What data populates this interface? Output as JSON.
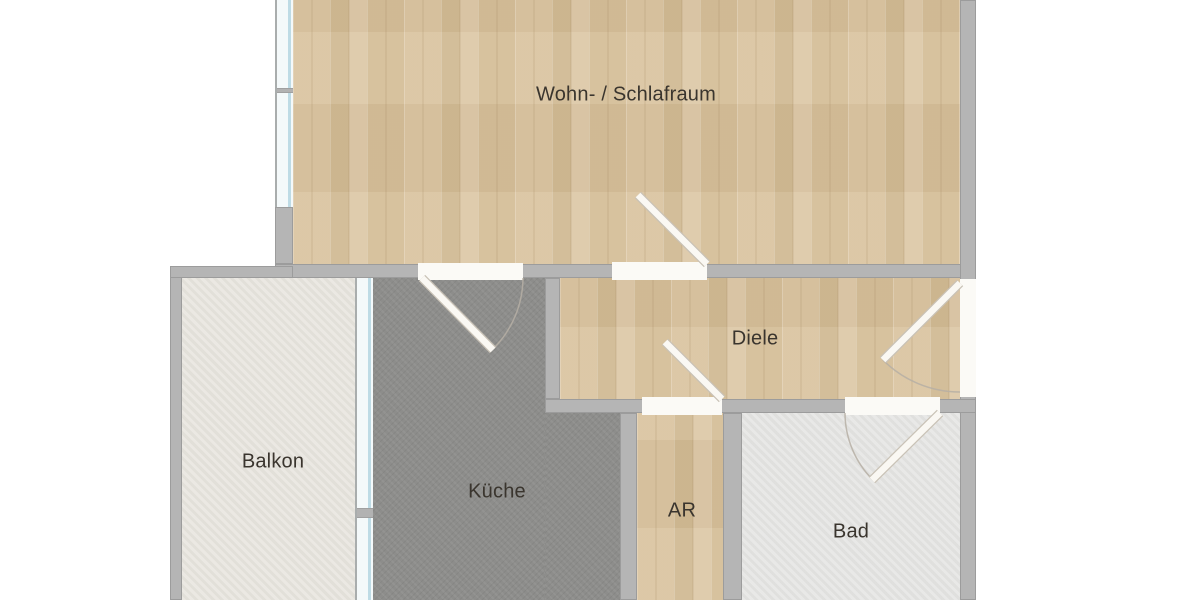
{
  "meta": {
    "type": "floor-plan",
    "canvas": {
      "width": 1200,
      "height": 600
    },
    "colors": {
      "background": "#ffffff",
      "wall": "#b5b5b5",
      "wall_edge": "#9c9c9c",
      "wood_floor": "#d7c09b",
      "kitchen_floor": "#8d8d8b",
      "bath_floor": "#e3e3e1",
      "balcony_floor": "#e6e3dc",
      "window_glass": "#bedbe5",
      "door_leaf": "#faf8f3",
      "label_text": "#3a352e"
    }
  },
  "rooms": [
    {
      "id": "wohnraum",
      "label": "Wohn- / Schlafraum",
      "floor": "wood",
      "x": 293,
      "y": 0,
      "w": 667,
      "h": 264,
      "label_x": 626,
      "label_y": 95
    },
    {
      "id": "diele",
      "label": "Diele",
      "floor": "wood",
      "x": 560,
      "y": 278,
      "w": 400,
      "h": 121,
      "label_x": 755,
      "label_y": 339
    },
    {
      "id": "kueche",
      "label": "Küche",
      "floor": "dark",
      "x": 373,
      "y": 278,
      "w": 172,
      "h": 322,
      "label_x": 497,
      "label_y": 492
    },
    {
      "id": "kueche-ext",
      "label": "",
      "floor": "dark",
      "x": 545,
      "y": 413,
      "w": 75,
      "h": 187
    },
    {
      "id": "ar",
      "label": "AR",
      "floor": "wood",
      "x": 637,
      "y": 413,
      "w": 86,
      "h": 187,
      "label_x": 682,
      "label_y": 511
    },
    {
      "id": "bad",
      "label": "Bad",
      "floor": "light",
      "x": 742,
      "y": 413,
      "w": 218,
      "h": 187,
      "label_x": 851,
      "label_y": 532
    },
    {
      "id": "balkon",
      "label": "Balkon",
      "floor": "balcony",
      "x": 182,
      "y": 278,
      "w": 173,
      "h": 322,
      "label_x": 273,
      "label_y": 462
    }
  ],
  "walls": [
    {
      "id": "west-wall-lower",
      "x": 275,
      "y": 207,
      "w": 18,
      "h": 57
    },
    {
      "id": "wohnraum-south-wall",
      "x": 275,
      "y": 264,
      "w": 701,
      "h": 14
    },
    {
      "id": "east-wall",
      "x": 960,
      "y": 0,
      "w": 16,
      "h": 600
    },
    {
      "id": "kueche-diele-wall",
      "x": 545,
      "y": 278,
      "w": 15,
      "h": 121
    },
    {
      "id": "diele-south-wall",
      "x": 545,
      "y": 399,
      "w": 431,
      "h": 14
    },
    {
      "id": "kueche-ar-wall",
      "x": 620,
      "y": 413,
      "w": 17,
      "h": 187
    },
    {
      "id": "ar-bad-wall",
      "x": 723,
      "y": 413,
      "w": 19,
      "h": 187
    },
    {
      "id": "balkon-west-wall",
      "x": 170,
      "y": 266,
      "w": 12,
      "h": 334
    },
    {
      "id": "balkon-north-wall",
      "x": 170,
      "y": 266,
      "w": 123,
      "h": 12
    }
  ],
  "windows": [
    {
      "id": "wohnraum-west-window",
      "x": 275,
      "y": 0,
      "w": 18,
      "h": 207,
      "mullions": [
        {
          "y": 88,
          "h": 5
        }
      ]
    },
    {
      "id": "balkon-kueche-window",
      "x": 355,
      "y": 278,
      "w": 18,
      "h": 322,
      "mullions": [
        {
          "y": 230,
          "h": 10
        }
      ]
    }
  ],
  "doors": [
    {
      "id": "wohnraum-door",
      "opening": {
        "x": 612,
        "y": 262,
        "w": 95,
        "h": 18
      },
      "leaf": {
        "x1": 707,
        "y1": 264,
        "x2": 638,
        "y2": 195
      },
      "arc": null
    },
    {
      "id": "kueche-door",
      "opening": {
        "x": 418,
        "y": 263,
        "w": 105,
        "h": 17
      },
      "leaf": {
        "x1": 422,
        "y1": 278,
        "x2": 493,
        "y2": 350
      },
      "arc": "M 523 278 A 101 101 0 0 1 493 349"
    },
    {
      "id": "ar-door",
      "opening": {
        "x": 642,
        "y": 397,
        "w": 80,
        "h": 18
      },
      "leaf": {
        "x1": 722,
        "y1": 399,
        "x2": 665,
        "y2": 342
      },
      "arc": null
    },
    {
      "id": "bad-door",
      "opening": {
        "x": 845,
        "y": 397,
        "w": 95,
        "h": 18
      },
      "leaf": {
        "x1": 940,
        "y1": 413,
        "x2": 872,
        "y2": 480
      },
      "arc": "M 845 413 A 95 95 0 0 0 873 480"
    },
    {
      "id": "entrance-door",
      "opening": {
        "x": 960,
        "y": 279,
        "w": 16,
        "h": 118
      },
      "leaf": {
        "x1": 960,
        "y1": 283,
        "x2": 883,
        "y2": 360
      },
      "arc": "M 883 360 A 109 109 0 0 0 960 392"
    }
  ]
}
